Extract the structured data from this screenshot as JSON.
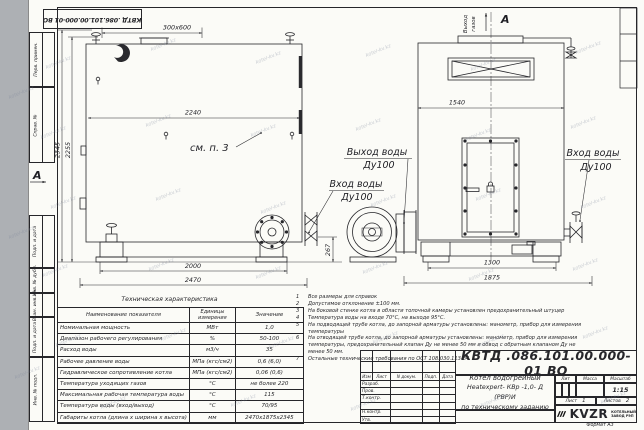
{
  "watermark": {
    "text": "kotel-kv.kz",
    "positions": [
      [
        45,
        60
      ],
      [
        150,
        42
      ],
      [
        255,
        55
      ],
      [
        365,
        48
      ],
      [
        470,
        62
      ],
      [
        575,
        45
      ],
      [
        40,
        130
      ],
      [
        145,
        118
      ],
      [
        250,
        128
      ],
      [
        355,
        122
      ],
      [
        465,
        132
      ],
      [
        570,
        120
      ],
      [
        50,
        200
      ],
      [
        155,
        192
      ],
      [
        260,
        205
      ],
      [
        370,
        198
      ],
      [
        475,
        192
      ],
      [
        580,
        200
      ],
      [
        42,
        268
      ],
      [
        148,
        262
      ],
      [
        255,
        270
      ],
      [
        362,
        265
      ],
      [
        468,
        272
      ],
      [
        572,
        262
      ],
      [
        55,
        338
      ],
      [
        160,
        332
      ],
      [
        268,
        340
      ],
      [
        372,
        335
      ],
      [
        478,
        338
      ],
      [
        582,
        330
      ],
      [
        100,
        400
      ],
      [
        230,
        398
      ],
      [
        350,
        402
      ],
      [
        480,
        398
      ],
      [
        600,
        395
      ],
      [
        8,
        90
      ],
      [
        8,
        230
      ],
      [
        14,
        370
      ]
    ]
  },
  "frame": {
    "top_doc_number": "КВТД .086.101.00.000-01 ВО",
    "left_labels": [
      "Перв. примен.",
      "Справ. №",
      "Подп. и дата",
      "Инв. № дубл.",
      "Взам. инв. №",
      "Подп. и дата",
      "Инв. № подл."
    ]
  },
  "drawing": {
    "section_label": "А",
    "view_note": "см. п. 3",
    "gas_outlet": {
      "word1": "Выход",
      "word2": "газов"
    },
    "labels": {
      "water_out": {
        "line1": "Выход воды",
        "line2": "Ду100"
      },
      "water_in_left": {
        "line1": "Вход воды",
        "line2": "Ду100"
      },
      "water_in_right": {
        "line1": "Вход воды",
        "line2": "Ду100"
      }
    },
    "dims": {
      "chimney": "300x600",
      "h_total": "2345",
      "h_body": "2255",
      "w_top": "2240",
      "w_legs": "2000",
      "w_total": "2470",
      "h_axis": "267",
      "front_w": "1540",
      "front_legs": "1300",
      "front_total": "1875"
    }
  },
  "notes": {
    "items": [
      {
        "n": "1",
        "text": "Все размеры для справок"
      },
      {
        "n": "2",
        "text": "Допустимое отклонение ±100 мм."
      },
      {
        "n": "3",
        "text": "На боковой стенке котла в области топочной камеры установлен предохранительный штуцер"
      },
      {
        "n": "4",
        "text": "Температура воды на входе 70°С, на выходе 95°С."
      },
      {
        "n": "5",
        "text": "На подводящей трубе котла, до запорной арматуры установлены: манометр, прибор для измерения температуры"
      },
      {
        "n": "6",
        "text": "На отводящей трубе котла, до запорной арматуры установлены: манометр, прибор для измерения температуры, предохранительный клапан Ду не менее 50 мм и обвод с обратным клапаном Ду не менее 50 мм."
      },
      {
        "n": "7",
        "text": "Остальные технические требования по ОСТ 108.030.113-84"
      }
    ]
  },
  "spec_table": {
    "title": "Техническая характеристика",
    "headers": {
      "name": "Наименование показателя",
      "units": "Единицы измерения",
      "value": "Значение"
    },
    "rows": [
      {
        "name": "Номинальная мощность",
        "units": "МВт",
        "value": "1,0"
      },
      {
        "name": "Диапазон рабочего регулирования",
        "units": "%",
        "value": "50-100"
      },
      {
        "name": "Расход воды",
        "units": "м3/ч",
        "value": "35"
      },
      {
        "name": "Рабочее давление воды",
        "units": "МПа (кгс/см2)",
        "value": "0,6 (6,0)"
      },
      {
        "name": "Гидравлическое сопротивление котла",
        "units": "МПа (кгс/см2)",
        "value": "0,06 (0,6)"
      },
      {
        "name": "Температура уходящих газов",
        "units": "°С",
        "value": "не более 220"
      },
      {
        "name": "Максимальная рабочая температура воды",
        "units": "°С",
        "value": "115"
      },
      {
        "name": "Температура воды (вход/выход)",
        "units": "°С",
        "value": "70/95"
      },
      {
        "name": "Габариты котла (длина х ширина х высота)",
        "units": "мм",
        "value": "2470х1875х2345"
      }
    ]
  },
  "title_block": {
    "doc_number": "КВТД .086.101.00.000-01 ВО",
    "product_line1": "Котел водогрейный",
    "product_line2": "Heatexpert- КВр -1,0- Д (РВР)И",
    "product_line3": "по техническому заданию",
    "col_izm": "Изм",
    "col_list": "Лист",
    "col_doc": "N докум.",
    "col_podp": "Подп.",
    "col_data": "Дата",
    "row_labels": [
      "Разраб.",
      "Пров.",
      "Т.контр.",
      "",
      "Н.контр.",
      "Утв."
    ],
    "lit_label": "Лит",
    "mass_label": "Масса",
    "scale_label": "Масштаб",
    "scale_value": "1:15",
    "sheet_label": "Лист",
    "sheet_value": "1",
    "sheets_label": "Листов",
    "sheets_value": "2",
    "logo_text": "KVZR",
    "logo_sub1": "КОТЕЛЬНЫЙ",
    "logo_sub2": "ЗАВОД РЭП",
    "format_label": "Формат А3"
  }
}
